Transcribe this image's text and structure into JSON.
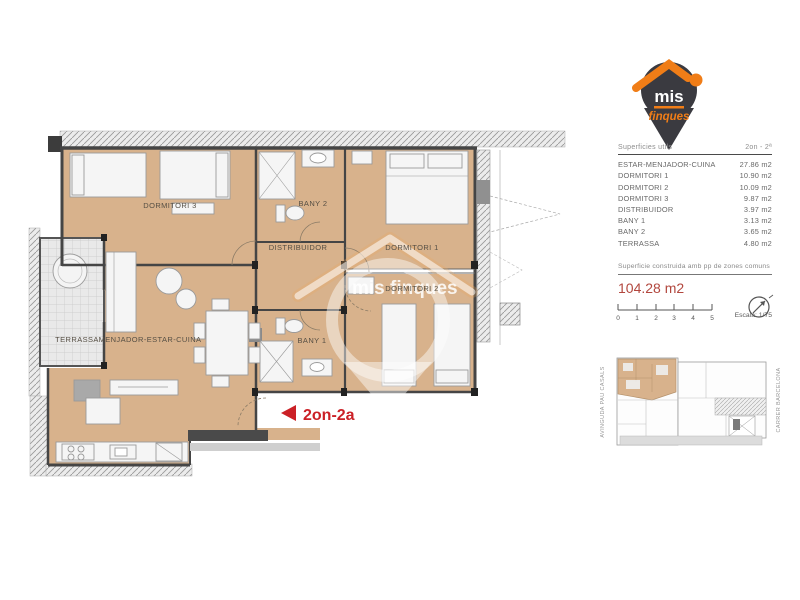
{
  "plan": {
    "unit_label": "2on-2a",
    "watermark_text": "mis finques",
    "rooms": [
      {
        "label": "DORMITORI 3"
      },
      {
        "label": "BANY 2"
      },
      {
        "label": "DORMITORI 1"
      },
      {
        "label": "DISTRIBUIDOR"
      },
      {
        "label": "BANY 1"
      },
      {
        "label": "DORMITORI 2"
      },
      {
        "label": "MENJADOR-ESTAR-CUINA"
      },
      {
        "label": "TERRASSA"
      }
    ]
  },
  "sidebar": {
    "logo": {
      "text_mis": "mis",
      "text_finques": "finques"
    },
    "table": {
      "header_left": "Superficies utils",
      "header_right": "2on - 2ª",
      "rows": [
        {
          "label": "ESTAR-MENJADOR-CUINA",
          "value": "27.86 m2"
        },
        {
          "label": "DORMITORI 1",
          "value": "10.90 m2"
        },
        {
          "label": "DORMITORI 2",
          "value": "10.09 m2"
        },
        {
          "label": "DORMITORI 3",
          "value": "9.87 m2"
        },
        {
          "label": "DISTRIBUIDOR",
          "value": "3.97 m2"
        },
        {
          "label": "BANY 1",
          "value": "3.13 m2"
        },
        {
          "label": "BANY 2",
          "value": "3.65 m2"
        },
        {
          "label": "TERRASSA",
          "value": "4.80 m2"
        }
      ]
    },
    "built_area_label": "Superficie construida amb pp de zones comuns",
    "built_area_value": "104.28 m2",
    "scale": {
      "ticks": [
        "0",
        "1",
        "2",
        "3",
        "4",
        "5"
      ],
      "label": "Escala: 1/75"
    },
    "siteplan": {
      "street_left": "AVINGUDA PAU CASALS",
      "street_right": "CARRER BARCELONA"
    }
  },
  "colors": {
    "accent_red": "#cb2026",
    "area_red": "#b2473e",
    "logo_orange": "#f07d17",
    "room_fill": "#d8b28c"
  }
}
